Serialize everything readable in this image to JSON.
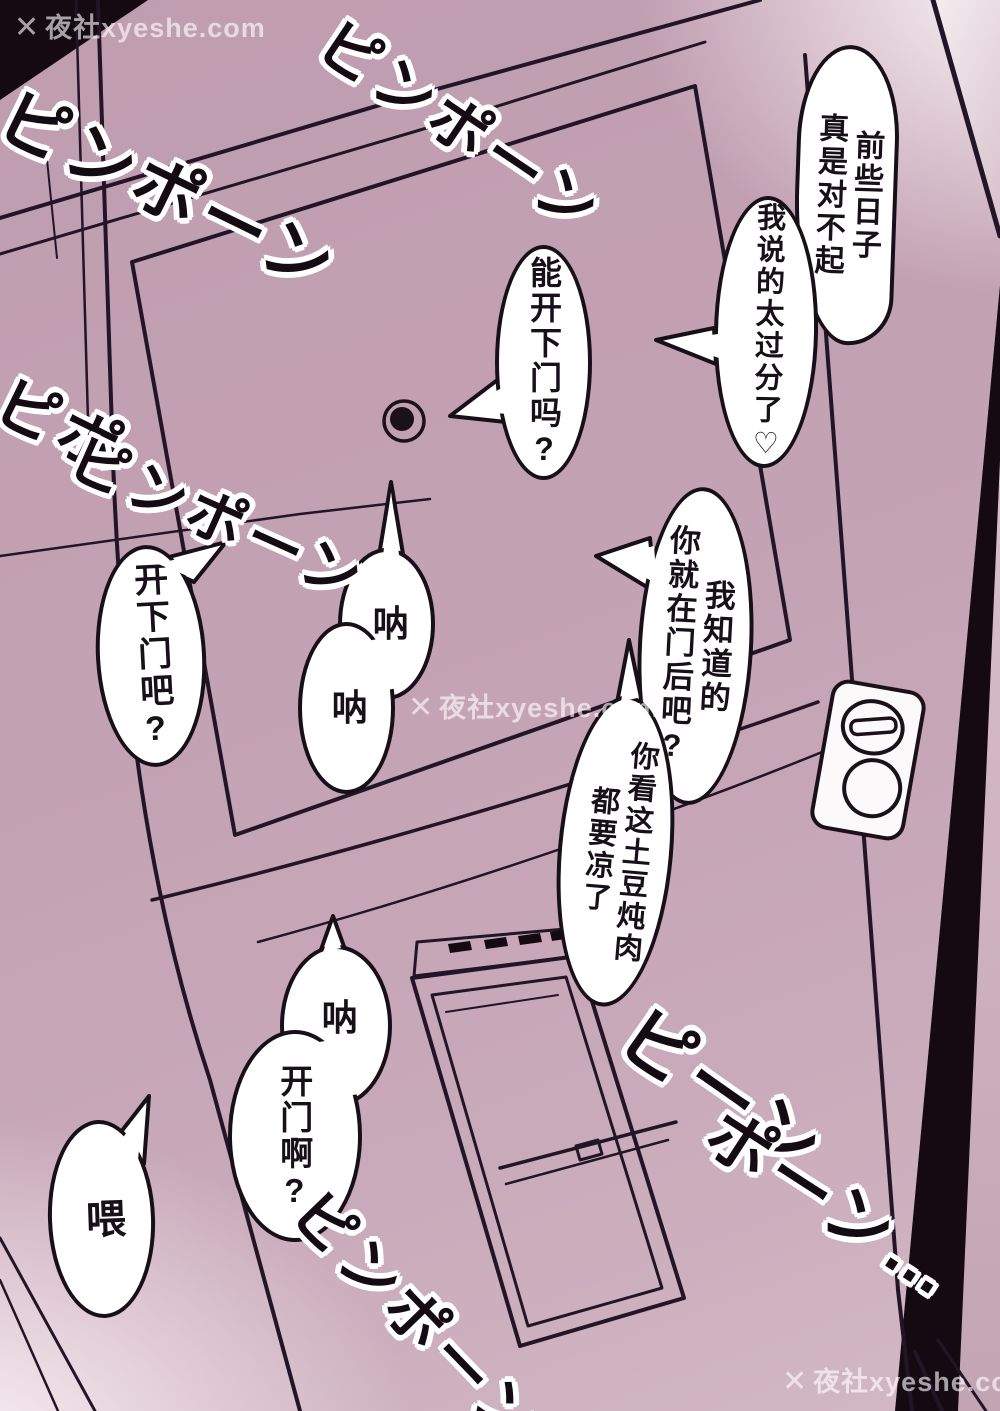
{
  "page": {
    "watermark": {
      "logo": "✕",
      "text": "夜社xyeshe.com"
    }
  },
  "colors": {
    "door": "#c3a2b3",
    "line_art": "#221527",
    "dark_frame": "#150a11",
    "bubble_fill": "#ffffff",
    "bubble_stroke": "#181018"
  },
  "bubbles": [
    {
      "name": "apology-intro",
      "text": "前些日子\n真是对不起"
    },
    {
      "name": "apology-heart",
      "text": "我说的太过分了♡"
    },
    {
      "name": "can-you-open",
      "text": "能开下门吗?"
    },
    {
      "name": "open-the-door",
      "text": "开下门吧?"
    },
    {
      "name": "hey-hey",
      "lines": [
        "呐",
        "呐"
      ]
    },
    {
      "name": "i-know-youre-there",
      "text": "我知道的\n你就在门后吧?"
    },
    {
      "name": "stew-getting-cold",
      "text": "你看这土豆炖肉\n都要凉了"
    },
    {
      "name": "hey-open-up",
      "lines": [
        "呐",
        "开门啊?"
      ]
    },
    {
      "name": "hey",
      "text": "喂"
    }
  ],
  "sfx": [
    {
      "name": "doorbell-top-left",
      "lines": [
        "ピンポーン"
      ]
    },
    {
      "name": "doorbell-top-center",
      "lines": [
        "ピンポーン"
      ]
    },
    {
      "name": "doorbell-left",
      "lines": [
        "ピポ",
        "ピンポーン"
      ]
    },
    {
      "name": "doorbell-bottom-right",
      "lines": [
        "ピーン",
        "ポーン…"
      ]
    },
    {
      "name": "doorbell-bottom-center",
      "lines": [
        "ピンポーン"
      ]
    }
  ]
}
